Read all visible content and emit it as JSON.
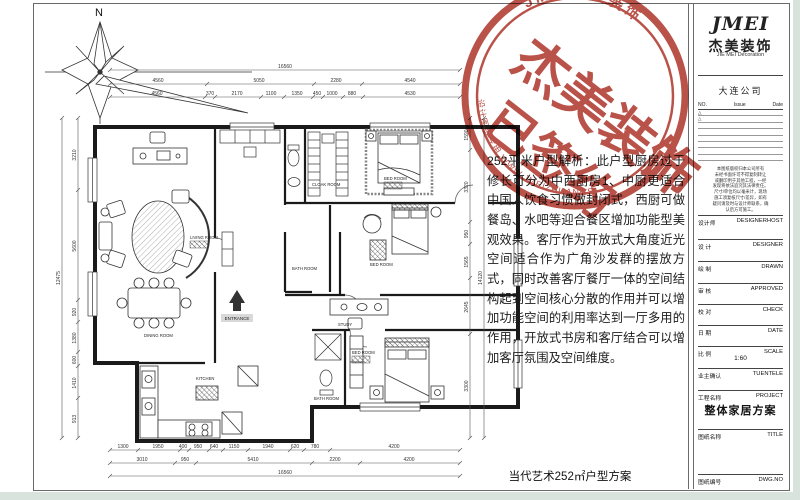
{
  "sheet": {
    "bottom_title": "当代艺术252㎡户型方案",
    "compass_label": "N"
  },
  "description": {
    "text": "252平米户型解析：此户型厨房过于修长可分为中西厨房1、中厨更适合中国人饮食习惯做封闭式，西厨可做餐岛、水吧等迎合餐区增加功能型美观效果。客厅作为开放式大角度近光空间适合作为广角沙发群的摆放方式，同时改善客厅餐厅一体的空间结构起到空间核心分散的作用并可以增加功能空间的利用率达到一厅多用的作用，开放式书房和客厅结合可以增加客厅氛围及空间维度。"
  },
  "stamp": {
    "color": "#b03a30",
    "arc_top_text": "JMEI杰美装饰",
    "big_line1": "杰美装饰",
    "big_line2": "已签约",
    "arc_bottom_text": "设计图纸专用 WWW.JMEIZHUANGSHI"
  },
  "title_block": {
    "logo": "JMEI",
    "company_cn": "杰美装饰",
    "company_en": "JIE MEI Decoration",
    "branch": "大连公司",
    "rev_header": {
      "no": "NO.",
      "issue": "Issue",
      "date": "Date"
    },
    "rev_marks": [
      "△",
      "△"
    ],
    "disclaimer_lines": [
      "本图纸版权归本公司所有",
      "未经书面许可不得复制转让",
      "或翻印用于其他工程，一经",
      "发现将依法追究其法律责任。",
      "尺寸/单位均以毫米计，现场",
      "施工须复核尺寸/差异，如有",
      "疑问请及时与设计师联系，确",
      "认后方可施工。"
    ],
    "rows": [
      {
        "cn": "设计师",
        "en": "DESIGNERHOST",
        "value": ""
      },
      {
        "cn": "设 计",
        "en": "DESIGNER",
        "value": ""
      },
      {
        "cn": "绘 制",
        "en": "DRAWN",
        "value": ""
      },
      {
        "cn": "审 核",
        "en": "APPROVED",
        "value": ""
      },
      {
        "cn": "校 对",
        "en": "CHECK",
        "value": ""
      },
      {
        "cn": "日 期",
        "en": "DATE",
        "value": ""
      },
      {
        "cn": "比 例",
        "en": "SCALE",
        "value": "1:60"
      },
      {
        "cn": "业主确认",
        "en": "TUENTELE",
        "value": ""
      },
      {
        "cn": "工程名称",
        "en": "PROJECT",
        "value": "整体家居方案"
      },
      {
        "cn": "图纸名称",
        "en": "TITLE",
        "value": ""
      },
      {
        "cn": "图纸编号",
        "en": "DWG.NO",
        "value": ""
      }
    ]
  },
  "plan": {
    "entrance_label": "ENTRANCE",
    "room_labels": [
      "LIVING ROOM",
      "DINING ROOM",
      "KITCHEN",
      "CLOAK ROOM",
      "BED ROOM",
      "BATH ROOM",
      "BED ROOM",
      "STUDY",
      "BED ROOM",
      "BATH ROOM"
    ],
    "dims": {
      "top_total": "16560",
      "top_mid": [
        "4560",
        "5050",
        "2280",
        "4540"
      ],
      "top_inner": [
        "4560",
        "370",
        "2170",
        "1100",
        "1350",
        "450",
        "1000",
        "880",
        "4530"
      ],
      "bottom_inner": [
        "1300",
        "1950",
        "400",
        "950",
        "640",
        "1150",
        "1940",
        "620",
        "780",
        "4200"
      ],
      "bottom_mid": [
        "3010",
        "950",
        "5410",
        "2200",
        "4200"
      ],
      "bottom_total": "16560",
      "left_total": "12475",
      "left_inner": [
        "3210",
        "5600",
        "920",
        "1380",
        "600",
        "1410",
        "913"
      ],
      "right_total": "14120",
      "right_inner": [
        "1590",
        "3320",
        "950",
        "1565",
        "2645",
        "3300"
      ]
    }
  }
}
